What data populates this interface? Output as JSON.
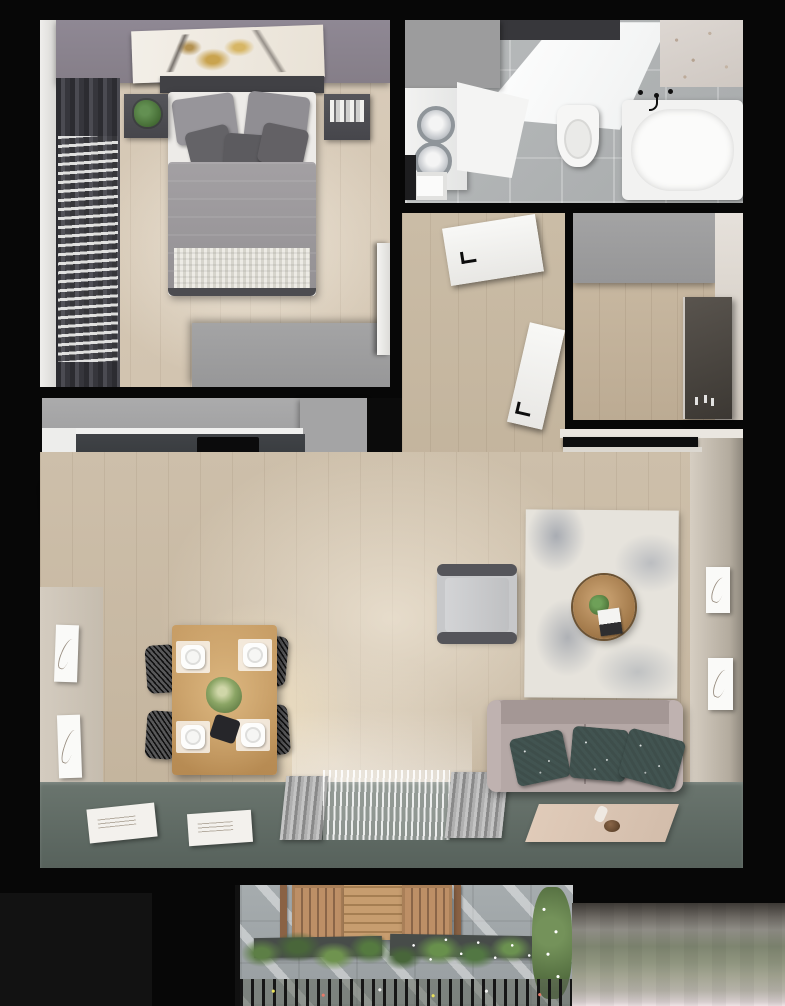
{
  "meta": {
    "description": "Top-down photorealistic 3D render of a one-bedroom apartment floor plan with balcony",
    "visible_text": "none",
    "view": "bird's-eye / top-down render"
  },
  "palette": {
    "walls_black": "#0b0b0b",
    "bedroom_wall_purple": "#8d8692",
    "bedroom_floor_wood": "#d6c9b6",
    "living_floor_wood": "#c9bba5",
    "bathroom_tile_gray": "#b2b5b6",
    "kitchen_counter_charcoal": "#3a3d41",
    "cooktop_black": "#0b0b0c",
    "gray_cabinetry": "#a0a0a1",
    "sofa_taupe": "#b5a8a6",
    "pillow_teal": "#415350",
    "rug_ivory": "#e6e3dc",
    "rug_mottle_blue": "#6c768a",
    "dining_table_wood": "#c89e66",
    "chair_black": "#2f2f31",
    "window_strip_green": "#5e6a63",
    "balcony_paver_gray": "#9fa6a8",
    "balcony_wood": "#b98b63",
    "plant_green": "#5d7f46",
    "exterior_gradient_top": "#3e3a36",
    "exterior_gradient_bottom": "#efe4e6"
  },
  "rooms": {
    "bedroom": {
      "label": "Bedroom",
      "items": [
        "double bed with gray duvet",
        "5 pillows",
        "headboard",
        "abstract wall art",
        "2 nightstands",
        "potted plant",
        "books",
        "wardrobe",
        "dark curtains with white blinds",
        "open door"
      ]
    },
    "bathroom": {
      "label": "Bathroom",
      "items": [
        "washer-dryer with 2 round doors",
        "white counter",
        "toilet",
        "bathtub with black fixtures",
        "marble accent tiles",
        "door frame"
      ]
    },
    "hallway": {
      "label": "Hallway",
      "items": [
        "open bathroom door",
        "open entry door"
      ]
    },
    "entry": {
      "label": "Entry",
      "items": [
        "gray wardrobe",
        "full-height mirror",
        "perfume bottles"
      ]
    },
    "kitchen": {
      "label": "Kitchen",
      "items": [
        "L-shaped charcoal counter",
        "black cooktop",
        "white sink with faucet",
        "tall cabinet",
        "open cabinet door",
        "drawer unit"
      ]
    },
    "dining": {
      "label": "Dining area",
      "items": [
        "wooden table",
        "4 black wire chairs",
        "4 place settings",
        "green centerpiece",
        "pendant light glow"
      ]
    },
    "living": {
      "label": "Living area",
      "items": [
        "taupe sofa with 3 patterned pillows",
        "gray armchair",
        "round wooden coffee table with plant",
        "distressed ivory-blue rug",
        "black media console",
        "4 framed line-art prints"
      ]
    },
    "window_wall": {
      "label": "Window wall strip",
      "items": [
        "slate-green floor strip",
        "2 white books/trays",
        "gray ribbed curtain panels",
        "white sheer curtain",
        "beige pet mat with bowl"
      ]
    },
    "balcony": {
      "label": "Balcony",
      "items": [
        "wooden table",
        "2 slatted wooden chairs",
        "planter boxes",
        "ornamental grasses with white flowers",
        "flowering bush",
        "railing with flowers"
      ]
    },
    "exterior": {
      "label": "Exterior ground",
      "items": [
        "blurred ground gradient"
      ]
    }
  },
  "counts": {
    "bed_pillows": 5,
    "sofa_pillows": 3,
    "dining_chairs": 4,
    "place_settings": 4,
    "wall_frames_left": 2,
    "wall_frames_right": 2,
    "washer_doors": 2,
    "balcony_chairs": 2
  }
}
